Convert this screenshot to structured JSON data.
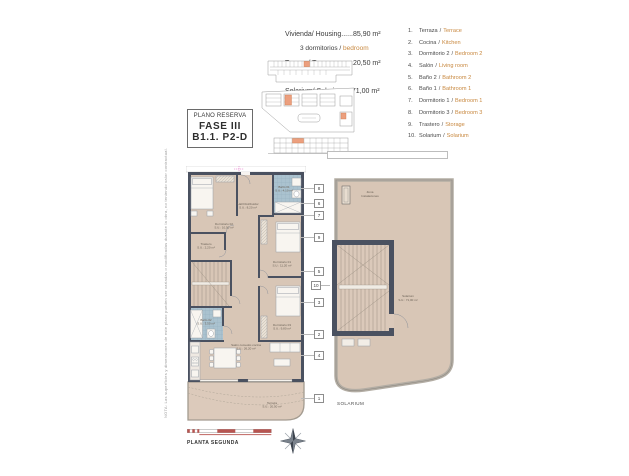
{
  "header": {
    "lines": [
      "Vivienda/ Housing......85,90 m²",
      "Terraza/ Terrace.........20,50 m²",
      "Solarium/ Solarium....71,00 m²"
    ],
    "bedrooms_es": "3 dormitorios / ",
    "bedrooms_en": "bedroom"
  },
  "reserve": {
    "line1": "PLANO RESERVA",
    "line2": "FASE III",
    "line3": "B1.1. P2-D"
  },
  "legend": {
    "separator": "/",
    "items": [
      {
        "num": "1.",
        "es": "Terraza",
        "en": "Terrace"
      },
      {
        "num": "2.",
        "es": "Cocina",
        "en": "Kitchen"
      },
      {
        "num": "3.",
        "es": "Dormitorio 2",
        "en": "Bedroom 2"
      },
      {
        "num": "4.",
        "es": "Salón",
        "en": "Living room"
      },
      {
        "num": "5.",
        "es": "Baño 2",
        "en": "Bathroom 2"
      },
      {
        "num": "6.",
        "es": "Baño 1",
        "en": "Bathroom 1"
      },
      {
        "num": "7.",
        "es": "Dormitorio 1",
        "en": "Bedroom 1"
      },
      {
        "num": "8.",
        "es": "Dormitorio 3",
        "en": "Bedroom 3"
      },
      {
        "num": "9.",
        "es": "Trastero",
        "en": "Storage"
      },
      {
        "num": "10.",
        "es": "Solarium",
        "en": "Solarium"
      }
    ]
  },
  "callouts": [
    "8",
    "6",
    "7",
    "9",
    "5",
    "10",
    "3",
    "2",
    "4",
    "1"
  ],
  "plan": {
    "rooms": {
      "dorm2": {
        "name": "Dormitorio 02",
        "area": "S.U.: 10,50 m²"
      },
      "hall": {
        "name": "Hall Distribuidor",
        "area": "S.U.: 8,20 m²"
      },
      "bath1": {
        "name": "Baño 01",
        "area": "S.U.: 4,10 m²"
      },
      "dorm1": {
        "name": "Dormitorio 01",
        "area": "S.U.: 11,20 m²"
      },
      "trastero": {
        "name": "Trastero",
        "area": "S.U.: 2,20 m²"
      },
      "bath2": {
        "name": "Baño 02",
        "area": "S.U.: 3,50 m²"
      },
      "dorm3": {
        "name": "Dormitorio 03",
        "area": "S.U.: 9,80 m²"
      },
      "salon": {
        "name": "Salón comedor-cocina",
        "area": "S.U.: 26,20 m²"
      },
      "terraza": {
        "name": "Terraza",
        "area": "S.U.: 20,50 m²"
      }
    }
  },
  "solarium": {
    "zona_line1": "Zona",
    "zona_line2": "Instalaciones",
    "name": "Solarium",
    "area": "S.U.: 71,00 m²",
    "caption": "SOLARIUM"
  },
  "footer": {
    "caption": "PLANTA SEGUNDA"
  },
  "note": "NOTA: Las superficies y dimensiones de este plano pueden ser variadas o modificadas durante la obra, no teniendo valor contractual.",
  "colors": {
    "accent_orange": "#c8883f",
    "highlight_orange": "#ec9f7e",
    "wall": "#4a5160",
    "floor": "#d8c6b6",
    "bath_blue": "#aac2cf",
    "scale_red": "#b85450"
  }
}
